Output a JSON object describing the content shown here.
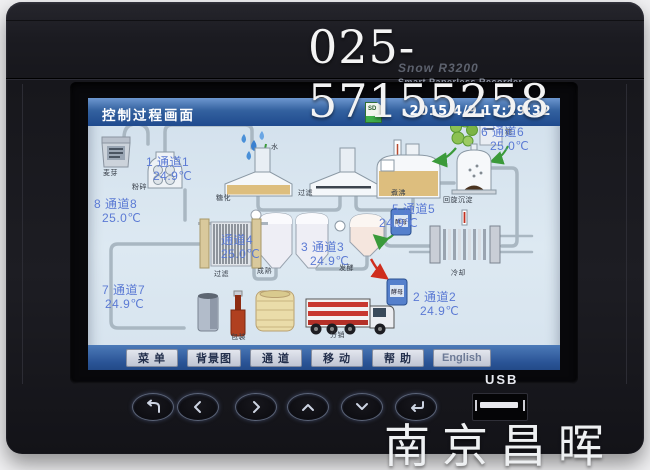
{
  "watermarks": {
    "phone": "025-57155258",
    "brand": "南京昌晖"
  },
  "device": {
    "model": "Snow R3200",
    "tagline": "Smart Paperless Recorder",
    "usb_label": "USB",
    "keys": [
      {
        "icon": "back-icon"
      },
      {
        "icon": "left-arrow-icon"
      },
      {
        "icon": "right-arrow-icon"
      },
      {
        "icon": "up-arrow-icon"
      },
      {
        "icon": "down-arrow-icon"
      },
      {
        "icon": "enter-icon"
      }
    ]
  },
  "screen": {
    "titlebar": {
      "title": "控制过程画面",
      "datetime": "2015/4/9 17:29:32",
      "icon": "sd-card-icon",
      "sd_text": "SD"
    },
    "channels": [
      {
        "label": "1 通道1",
        "value": "24.9℃"
      },
      {
        "label": "2 通道2",
        "value": "24.9℃"
      },
      {
        "label": "3 通道3",
        "value": "24.9℃"
      },
      {
        "label": "通道4",
        "value": "25.0℃"
      },
      {
        "label": "5 通道5",
        "value": "24.9℃"
      },
      {
        "label": "6 通道6",
        "value": "25.0℃"
      },
      {
        "label": "7 通道7",
        "value": "24.9℃"
      },
      {
        "label": "8 通道8",
        "value": "25.0℃"
      }
    ],
    "process_labels": {
      "malt": "麦芽",
      "mill": "粉碎",
      "water": "水",
      "mash": "糖化",
      "lauter": "过滤",
      "boil": "煮沸",
      "hops": "酒花",
      "sugar": "糖",
      "whirlpool": "回旋沉淀",
      "yeast": "酵母",
      "cool": "冷却",
      "ferment": "发酵",
      "mature": "成熟",
      "filter": "过滤",
      "package": "包装",
      "distribute": "分销"
    },
    "menu": {
      "items": [
        "菜 单",
        "背景图",
        "通 道",
        "移 动",
        "帮 助",
        "English"
      ]
    }
  },
  "colors": {
    "titlebar_blue": "#2e5ba0",
    "menu_blue": "#2d5a9e",
    "channel_text": "#5b7ad4",
    "tan_liquid": "#ddbe7e",
    "screen_bg": "#d9e5ee"
  }
}
